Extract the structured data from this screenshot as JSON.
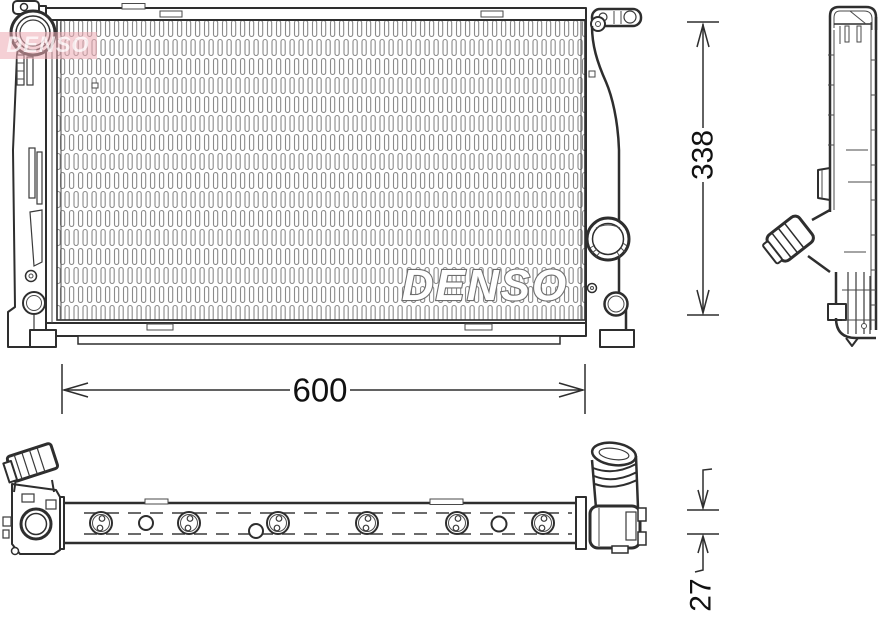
{
  "brand_logo": {
    "text": "DENSO"
  },
  "watermark": {
    "text": "DENSO",
    "band_color": "#edaab2",
    "band_opacity": "0.55"
  },
  "dimensions": {
    "width": {
      "value": "600"
    },
    "height": {
      "value": "338"
    },
    "depth": {
      "value": "27"
    }
  },
  "colors": {
    "line": "#2e2e2e",
    "hatch": "#8a8a8a",
    "background": "#ffffff",
    "logo_outline": "#6e6e6e"
  }
}
